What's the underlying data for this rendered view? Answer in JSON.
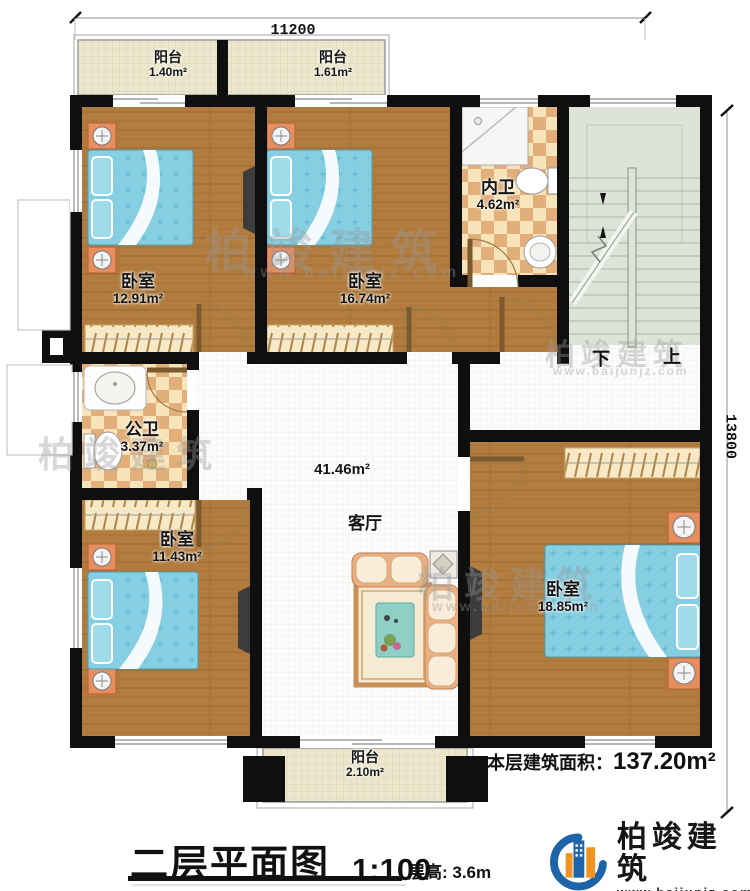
{
  "dimensions": {
    "top": "11200",
    "right": "13800"
  },
  "rooms": {
    "balcony_top_left": {
      "name": "阳台",
      "area": "1.40m²"
    },
    "balcony_top_mid": {
      "name": "阳台",
      "area": "1.61m²"
    },
    "bedroom_top_left": {
      "name": "卧室",
      "area": "12.91m²"
    },
    "bedroom_top_mid": {
      "name": "卧室",
      "area": "16.74m²"
    },
    "ensuite_bath": {
      "name": "内卫",
      "area": "4.62m²"
    },
    "public_bath": {
      "name": "公卫",
      "area": "3.37m²"
    },
    "bedroom_bottom_left": {
      "name": "卧室",
      "area": "11.43m²"
    },
    "living_room": {
      "name": "客厅",
      "area": "41.46m²"
    },
    "bedroom_master": {
      "name": "卧室",
      "area": "18.85m²"
    },
    "balcony_bottom": {
      "name": "阳台",
      "area": "2.10m²"
    }
  },
  "stairs": {
    "down_label": "下",
    "up_label": "上"
  },
  "footer": {
    "area_label": "本层建筑面积：",
    "area_value": "137.20m²",
    "plan_title": "二层平面图",
    "scale": "1:100",
    "floor_height": "层高: 3.6m"
  },
  "brand": {
    "name": "柏竣建筑",
    "website": "www.baijunjz.com"
  },
  "watermark": {
    "name": "柏竣建筑",
    "website": "www.baijunjz.com"
  },
  "colors": {
    "wall": "#0f0f0f",
    "wood": "#b17c3d",
    "bed_blue": "#86cfe2",
    "checker_dark": "#e2ae79",
    "checker_light": "#f7e4ba",
    "stair": "#dde3d7",
    "balcony": "#ebe6cc",
    "logo_blue": "#1d64a8",
    "logo_orange": "#f0941f"
  }
}
